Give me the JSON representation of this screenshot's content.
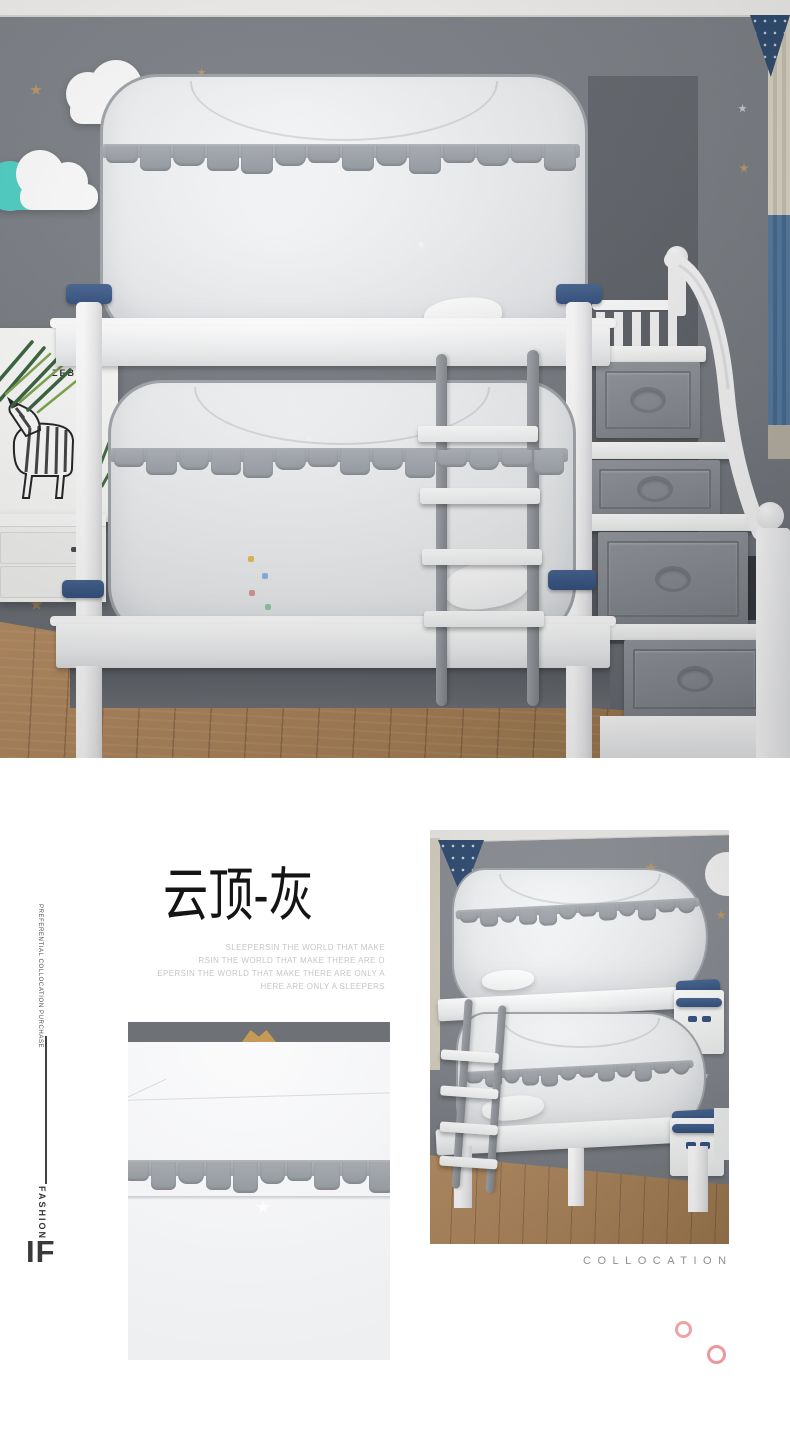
{
  "hero": {
    "scene": "kids bedroom bunk bed with pop-up mosquito net tents",
    "zebra_print_label": "ZEBRA",
    "colors": {
      "wall": "#75797f",
      "ceiling": "#f2f1ef",
      "floor_wood": "#aa8257",
      "net_mesh": "#edeff1",
      "net_trim": "#9aa0a6",
      "bed_frame": "#ffffff",
      "navy_accent": "#33507d",
      "teal_cloud": "#4bcfc4",
      "gold_star": "#bb9765",
      "silver_star": "#c9ccd0",
      "stair_drawer": "#878b91",
      "curtain_blue": "#4d74a1",
      "curtain_beige": "#d5cec0"
    }
  },
  "info": {
    "title": "云顶-灰",
    "tagline_lines": [
      "SLEEPERSIN THE WORLD  THAT  MAKE",
      "RSIN THE WORLD  THAT  MAKE THERE ARE O",
      "EPERSIN THE WORLD  THAT  MAKE  THERE ARE ONLY A",
      "HERE ARE ONLY A SLEEPERS"
    ],
    "side_rail": {
      "vertical_text": "PREFERENTIAL COLLOCATION PURCHASE",
      "fashion_label": "FASHION",
      "if_label": "IF"
    },
    "collocation_label": "COLLOCATION",
    "accent_pink": "#efa0a0"
  }
}
